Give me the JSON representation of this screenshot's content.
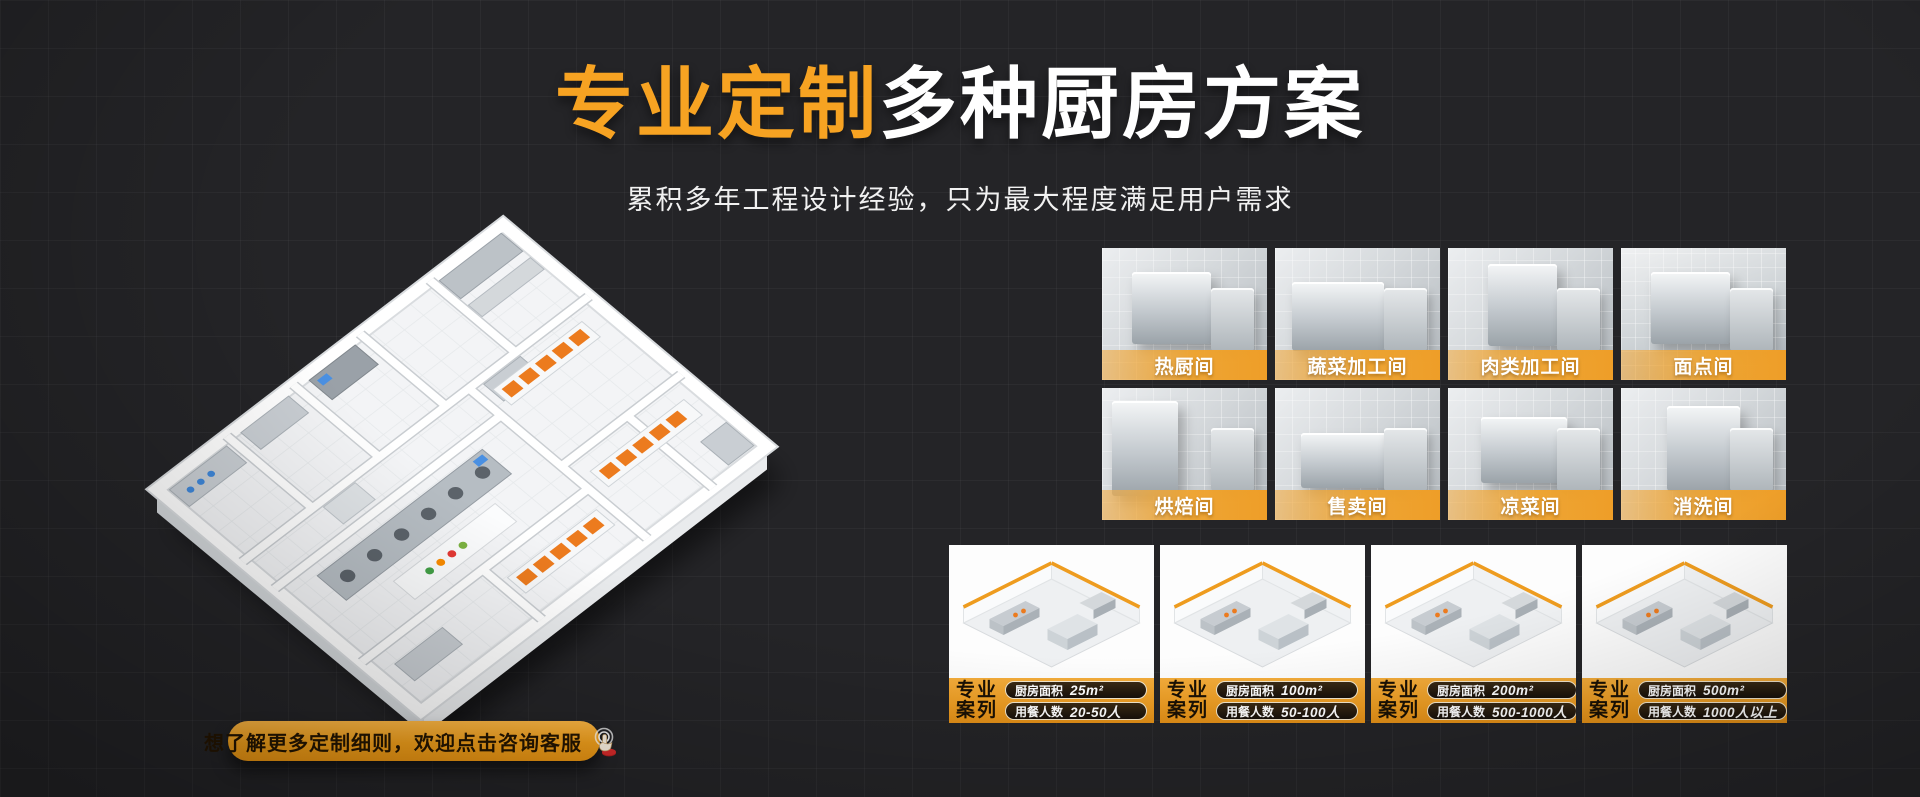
{
  "colors": {
    "accent": "#F7A322",
    "background": "#242427",
    "label_bar": "#EE9E28"
  },
  "header": {
    "title_highlight": "专业定制",
    "title_rest": "多种厨房方案",
    "subtitle": "累积多年工程设计经验，只为最大程度满足用户需求"
  },
  "cta": {
    "label": "想了解更多定制细则，欢迎点击咨询客服",
    "icon": "click-hand-icon"
  },
  "rooms": {
    "row1": [
      {
        "label": "热厨间"
      },
      {
        "label": "蔬菜加工间"
      },
      {
        "label": "肉类加工间"
      },
      {
        "label": "面点间"
      }
    ],
    "row2": [
      {
        "label": "烘焙间"
      },
      {
        "label": "售卖间"
      },
      {
        "label": "凉菜间"
      },
      {
        "label": "消洗间"
      }
    ]
  },
  "cases": {
    "badge_line1": "专业",
    "badge_line2": "案列",
    "items": [
      {
        "area_label": "厨房面积",
        "area_value": "25m²",
        "diners_label": "用餐人数",
        "diners_value": "20-50人"
      },
      {
        "area_label": "厨房面积",
        "area_value": "100m²",
        "diners_label": "用餐人数",
        "diners_value": "50-100人"
      },
      {
        "area_label": "厨房面积",
        "area_value": "200m²",
        "diners_label": "用餐人数",
        "diners_value": "500-1000人"
      },
      {
        "area_label": "厨房面积",
        "area_value": "500m²",
        "diners_label": "用餐人数",
        "diners_value": "1000人以上"
      }
    ]
  }
}
